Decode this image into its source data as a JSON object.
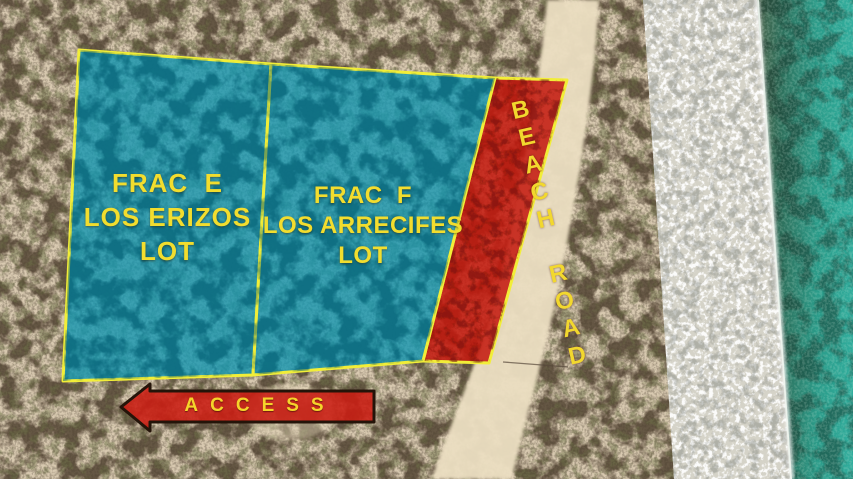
{
  "lots": [
    {
      "lines": [
        "FRAC  E",
        "LOS ERIZOS",
        "LOT"
      ]
    },
    {
      "lines": [
        "FRAC  F",
        "LOS ARRECIFES",
        "LOT"
      ]
    }
  ],
  "beach_road": {
    "label": "BEACH ROAD"
  },
  "access": {
    "label": "ACCESS"
  },
  "colors": {
    "lot_overlay": "#0e95b1",
    "road_overlay": "#c4170d",
    "boundary_yellow": "#f2ee38",
    "label_yellow": "#f2dd2e",
    "arrow_fill": "#cb1d12",
    "arrow_outline": "#241409"
  }
}
